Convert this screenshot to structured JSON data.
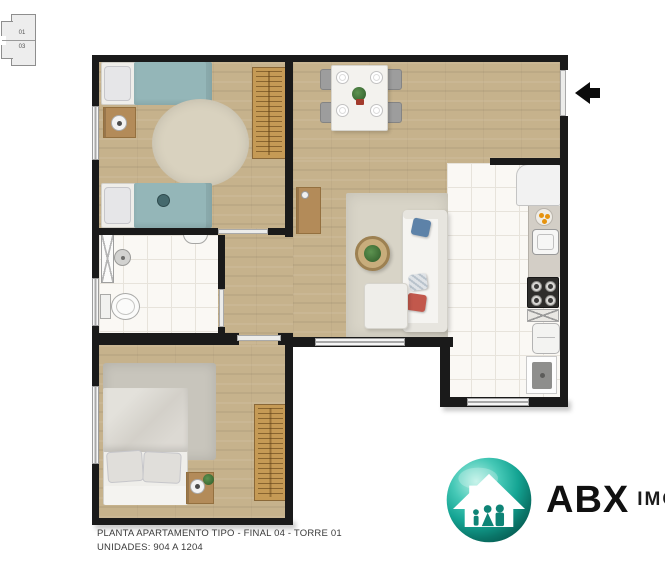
{
  "keyplan": {
    "unit_top": "01",
    "unit_bottom": "03"
  },
  "footer": {
    "line1": "PLANTA APARTAMENTO TIPO - FINAL 04 - TORRE 01",
    "line2": "UNIDADES: 904 A 1204"
  },
  "logo": {
    "brand": "ABX",
    "suffix": "IMO"
  },
  "palette": {
    "wall": "#1a1a1a",
    "wood_floor": "#c6b28c",
    "tile_floor": "#faf8f4",
    "bed_blanket_teal": "#94b6b8",
    "wardrobe_wood": "#c59a55",
    "cabinet_wood": "#b38b59",
    "sofa_white": "#f5f4f1",
    "pillow_blue": "#5d82a8",
    "pillow_red": "#c2584c",
    "logo_teal": "#14a493",
    "entrance_arrow": "#0b0b0b"
  }
}
